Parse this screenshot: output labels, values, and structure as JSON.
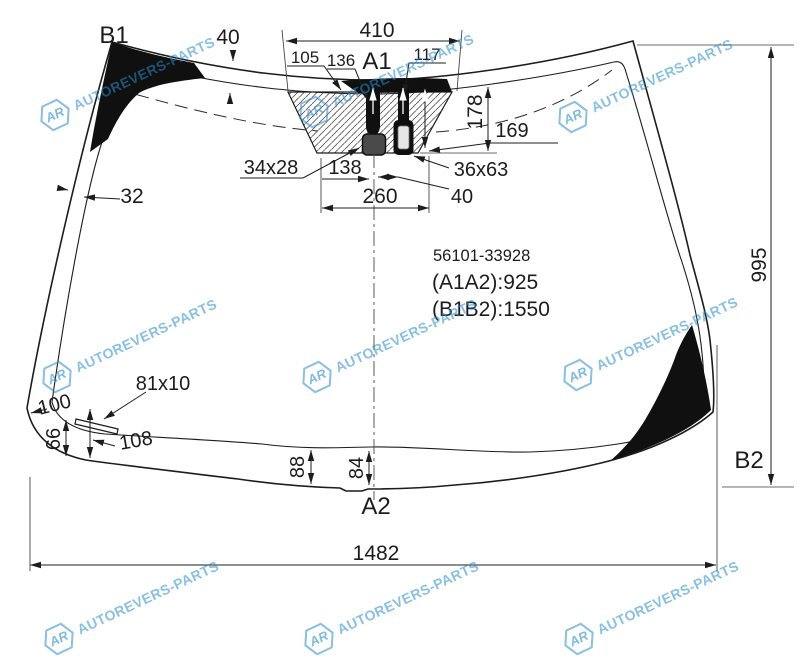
{
  "brand": {
    "logo_abbr": "AR",
    "name": "AUTOREVERS-PARTS",
    "watermark_color": "#2d8cc8"
  },
  "part": {
    "number": "56101-33928",
    "diagonal_a": "(A1A2):925",
    "diagonal_b": "(B1B2):1550"
  },
  "points": {
    "top_left": "B1",
    "top_center": "A1",
    "bottom_center": "A2",
    "bottom_right": "B2"
  },
  "dims": {
    "mount_top_width": "410",
    "top_band_40": "40",
    "offset_105": "105",
    "offset_136": "136",
    "offset_117": "117",
    "mount_height_178": "178",
    "mount_height_169": "169",
    "bracket_size": "34x28",
    "sensor_size": "36x63",
    "offset_138": "138",
    "sensor_gap_40": "40",
    "mount_bottom_width": "260",
    "side_band_32": "32",
    "overall_height": "995",
    "overall_width": "1482",
    "sticker_size": "81x10",
    "corner_100": "100",
    "corner_66": "66",
    "corner_108": "108",
    "bottom_band_88": "88",
    "bottom_band_84": "84"
  }
}
